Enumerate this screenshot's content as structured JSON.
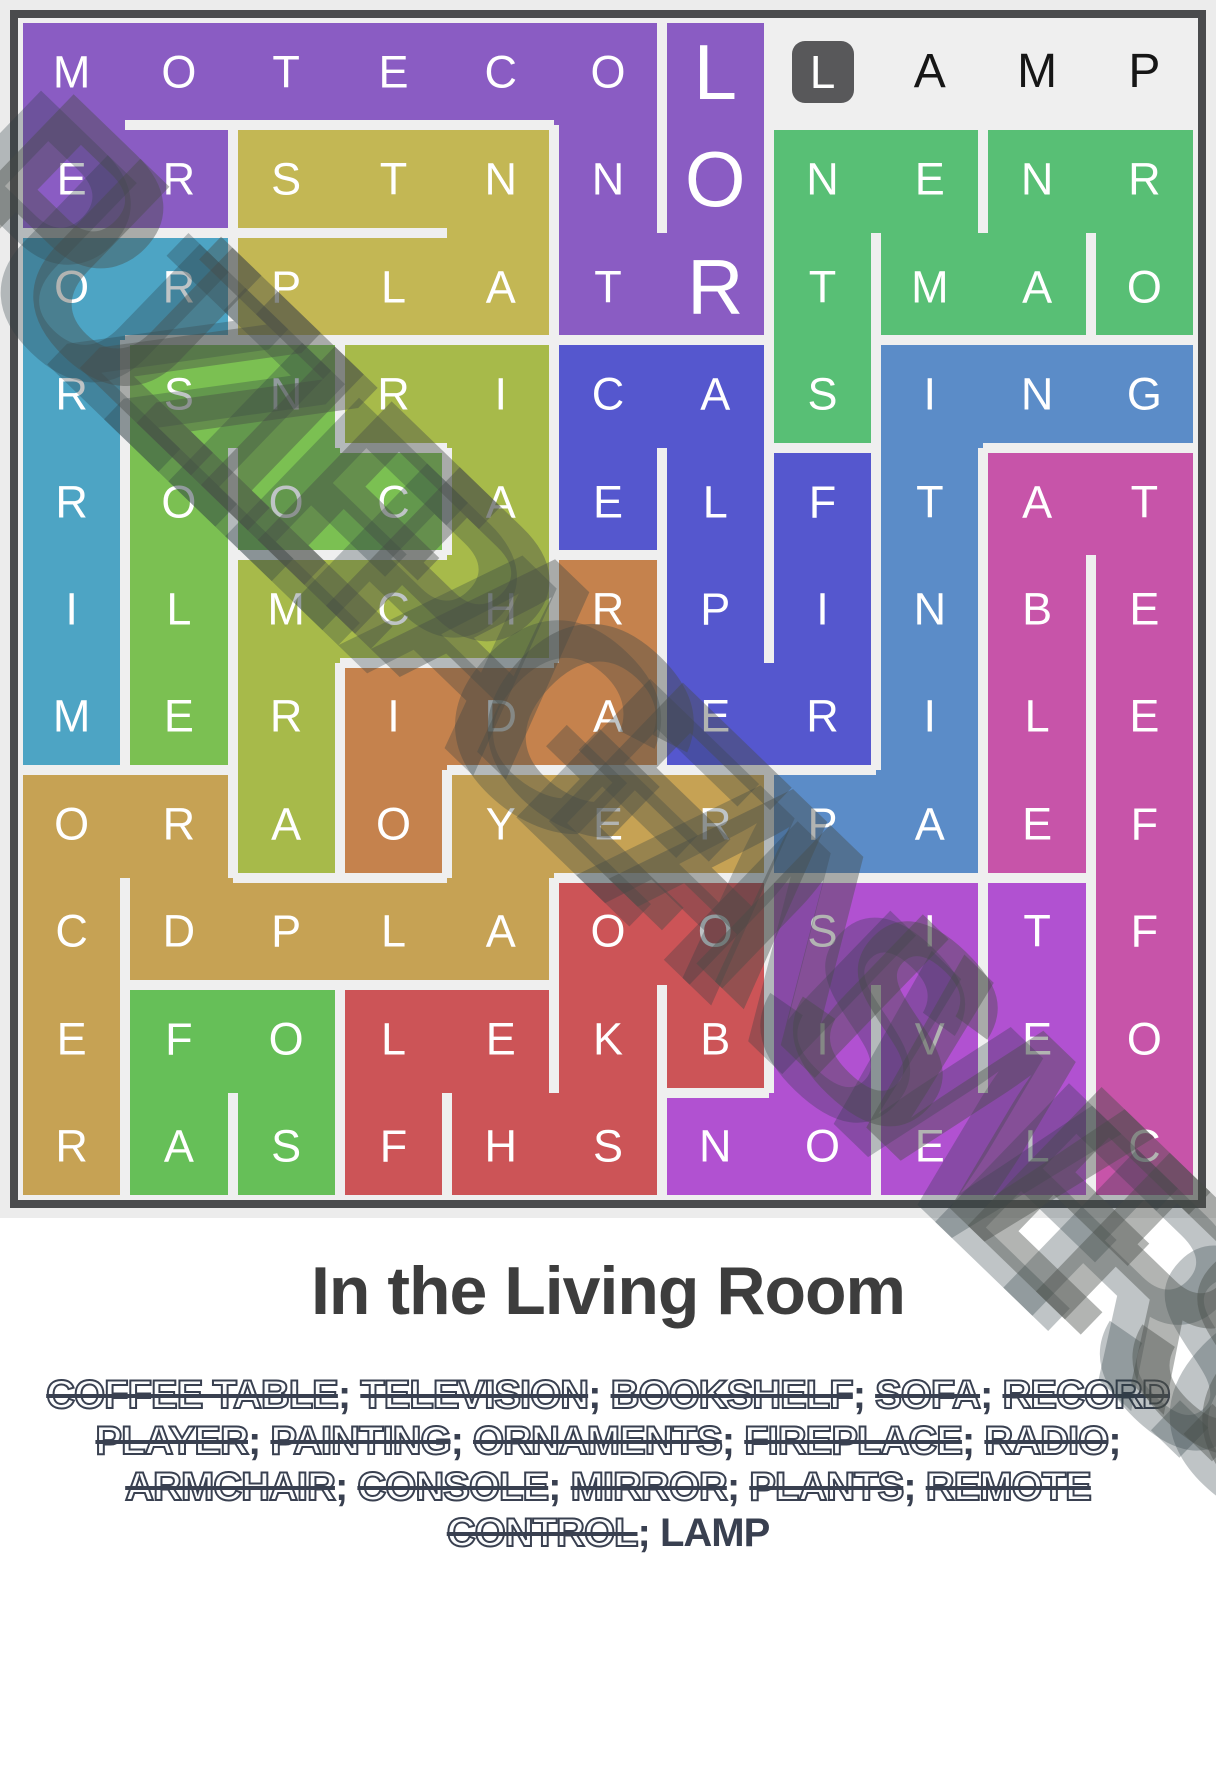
{
  "title": "In the Living Room",
  "watermark": {
    "text": "PUZZLEPAGEANSWERS.GURU"
  },
  "colors": {
    "page_bg": "#ececec",
    "grid_border": "#4a4b4d",
    "grid_gutter": "#efefef",
    "found_letter": "#ffffff",
    "unfound_letter": "#161616",
    "selected_box": "#58585a",
    "title_text": "#3d3d3d",
    "word_list_text": "#394050"
  },
  "puzzle": {
    "grid_size": {
      "rows": 11,
      "cols": 11
    },
    "rows": [
      "MOTECOLLAMP",
      "ERSTNNONENR",
      "ORPLATRTMAO",
      "RSNRICASING",
      "ROOCAELFTAT",
      "ILMCHRPINBE",
      "MERIDAERILE",
      "ORAOYERPAEF",
      "CDPLAOOSITF",
      "EFOLEKBIVEO",
      "RASFHSNOELC"
    ],
    "big_cells": [
      [
        1,
        7
      ],
      [
        2,
        7
      ],
      [
        3,
        7
      ]
    ],
    "selected_cell": [
      1,
      8
    ],
    "words": [
      {
        "word": "COFFEE TABLE",
        "found": true,
        "color": "#c754a9",
        "path": [
          [
            11,
            11
          ],
          [
            10,
            11
          ],
          [
            9,
            11
          ],
          [
            8,
            11
          ],
          [
            7,
            11
          ],
          [
            6,
            11
          ],
          [
            5,
            11
          ],
          [
            5,
            10
          ],
          [
            6,
            10
          ],
          [
            7,
            10
          ],
          [
            8,
            10
          ]
        ]
      },
      {
        "word": "TELEVISION",
        "found": true,
        "color": "#b151d1",
        "path": [
          [
            9,
            10
          ],
          [
            10,
            10
          ],
          [
            11,
            10
          ],
          [
            11,
            9
          ],
          [
            10,
            9
          ],
          [
            9,
            9
          ],
          [
            9,
            8
          ],
          [
            10,
            8
          ],
          [
            11,
            8
          ],
          [
            11,
            7
          ]
        ]
      },
      {
        "word": "BOOKSHELF",
        "found": true,
        "color": "#cc5457",
        "path": [
          [
            10,
            7
          ],
          [
            9,
            7
          ],
          [
            9,
            6
          ],
          [
            10,
            6
          ],
          [
            11,
            6
          ],
          [
            11,
            5
          ],
          [
            10,
            5
          ],
          [
            10,
            4
          ],
          [
            11,
            4
          ]
        ]
      },
      {
        "word": "SOFA",
        "found": true,
        "color": "#66bf58",
        "path": [
          [
            11,
            3
          ],
          [
            10,
            3
          ],
          [
            10,
            2
          ],
          [
            11,
            2
          ]
        ]
      },
      {
        "word": "RECORD PLAYER",
        "found": true,
        "color": "#c6a254",
        "path": [
          [
            11,
            1
          ],
          [
            10,
            1
          ],
          [
            9,
            1
          ],
          [
            8,
            1
          ],
          [
            8,
            2
          ],
          [
            9,
            2
          ],
          [
            9,
            3
          ],
          [
            9,
            4
          ],
          [
            9,
            5
          ],
          [
            8,
            5
          ],
          [
            8,
            6
          ],
          [
            8,
            7
          ]
        ]
      },
      {
        "word": "PAINTING",
        "found": true,
        "color": "#5b8cc8",
        "path": [
          [
            8,
            8
          ],
          [
            8,
            9
          ],
          [
            7,
            9
          ],
          [
            6,
            9
          ],
          [
            5,
            9
          ],
          [
            4,
            9
          ],
          [
            4,
            10
          ],
          [
            4,
            11
          ]
        ]
      },
      {
        "word": "ORNAMENTS",
        "found": true,
        "color": "#58bf75",
        "path": [
          [
            3,
            11
          ],
          [
            2,
            11
          ],
          [
            2,
            10
          ],
          [
            3,
            10
          ],
          [
            3,
            9
          ],
          [
            2,
            9
          ],
          [
            2,
            8
          ],
          [
            3,
            8
          ],
          [
            4,
            8
          ]
        ]
      },
      {
        "word": "FIREPLACE",
        "found": true,
        "color": "#5557ce",
        "path": [
          [
            5,
            8
          ],
          [
            6,
            8
          ],
          [
            7,
            8
          ],
          [
            7,
            7
          ],
          [
            6,
            7
          ],
          [
            5,
            7
          ],
          [
            4,
            7
          ],
          [
            4,
            6
          ],
          [
            5,
            6
          ]
        ]
      },
      {
        "word": "RADIO",
        "found": true,
        "color": "#c5824d",
        "path": [
          [
            6,
            6
          ],
          [
            7,
            6
          ],
          [
            7,
            5
          ],
          [
            7,
            4
          ],
          [
            8,
            4
          ]
        ]
      },
      {
        "word": "ARMCHAIR",
        "found": true,
        "color": "#a7ba4a",
        "path": [
          [
            8,
            3
          ],
          [
            7,
            3
          ],
          [
            6,
            3
          ],
          [
            6,
            4
          ],
          [
            6,
            5
          ],
          [
            5,
            5
          ],
          [
            4,
            5
          ],
          [
            4,
            4
          ]
        ]
      },
      {
        "word": "CONSOLE",
        "found": true,
        "color": "#7bc052",
        "path": [
          [
            5,
            4
          ],
          [
            5,
            3
          ],
          [
            4,
            3
          ],
          [
            4,
            2
          ],
          [
            5,
            2
          ],
          [
            6,
            2
          ],
          [
            7,
            2
          ]
        ]
      },
      {
        "word": "MIRROR",
        "found": true,
        "color": "#4da4c4",
        "path": [
          [
            7,
            1
          ],
          [
            6,
            1
          ],
          [
            5,
            1
          ],
          [
            4,
            1
          ],
          [
            3,
            1
          ],
          [
            3,
            2
          ]
        ]
      },
      {
        "word": "PLANTS",
        "found": true,
        "color": "#c3b754",
        "path": [
          [
            3,
            3
          ],
          [
            3,
            4
          ],
          [
            3,
            5
          ],
          [
            2,
            5
          ],
          [
            2,
            4
          ],
          [
            2,
            3
          ]
        ]
      },
      {
        "word": "REMOTE CONTROL",
        "found": true,
        "color": "#8a5cc3",
        "path": [
          [
            2,
            2
          ],
          [
            2,
            1
          ],
          [
            1,
            1
          ],
          [
            1,
            2
          ],
          [
            1,
            3
          ],
          [
            1,
            4
          ],
          [
            1,
            5
          ],
          [
            1,
            6
          ],
          [
            2,
            6
          ],
          [
            3,
            6
          ],
          [
            3,
            7
          ],
          [
            2,
            7
          ],
          [
            1,
            7
          ]
        ]
      },
      {
        "word": "LAMP",
        "found": false,
        "color": null,
        "path": [
          [
            1,
            8
          ],
          [
            1,
            9
          ],
          [
            1,
            10
          ],
          [
            1,
            11
          ]
        ]
      }
    ]
  }
}
